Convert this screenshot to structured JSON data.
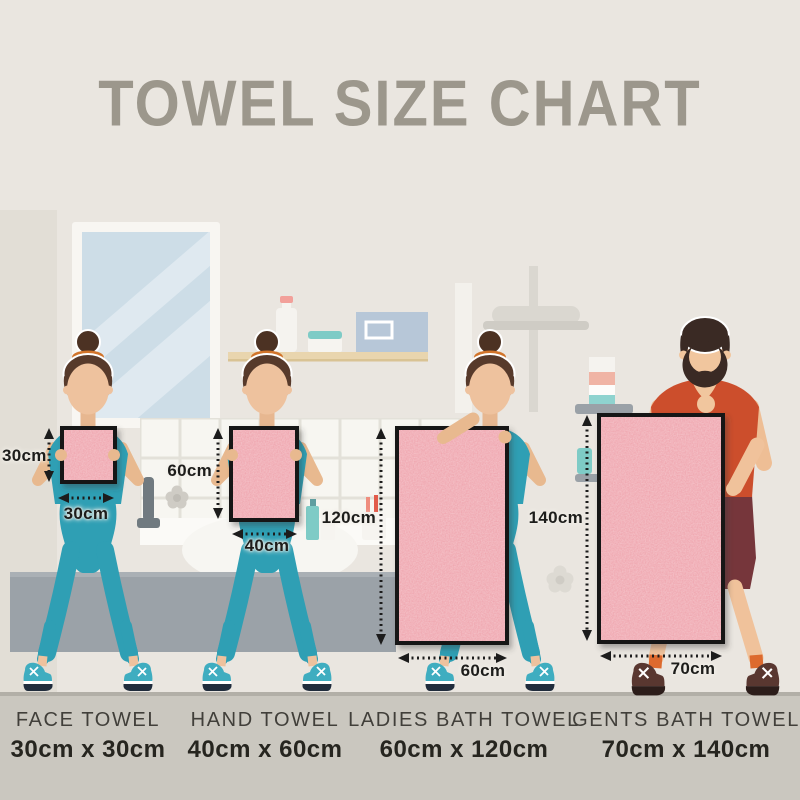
{
  "title": "TOWEL SIZE CHART",
  "towels": [
    {
      "name": "FACE TOWEL",
      "size": "30cm x 30cm",
      "width_cm": 30,
      "height_cm": 30,
      "width_label": "30cm",
      "height_label": "30cm"
    },
    {
      "name": "HAND TOWEL",
      "size": "40cm x 60cm",
      "width_cm": 40,
      "height_cm": 60,
      "width_label": "40cm",
      "height_label": "60cm"
    },
    {
      "name": "LADIES BATH TOWEL",
      "size": "60cm x 120cm",
      "width_cm": 60,
      "height_cm": 120,
      "width_label": "60cm",
      "height_label": "120cm"
    },
    {
      "name": "GENTS BATH TOWEL",
      "size": "70cm x 140cm",
      "width_cm": 70,
      "height_cm": 140,
      "width_label": "70cm",
      "height_label": "140cm"
    }
  ],
  "colors": {
    "wall": "#eae6e0",
    "floor": "#cac7bf",
    "title_gray": "#9c978c",
    "towel_pink": "#efa6af",
    "towel_border": "#161616",
    "teal_outfit": "#2f9fb4",
    "mens_shirt": "#cc4e2c",
    "mens_shorts": "#76363b",
    "skin": "#eec29e",
    "arrow_black": "#1c1c1c"
  }
}
